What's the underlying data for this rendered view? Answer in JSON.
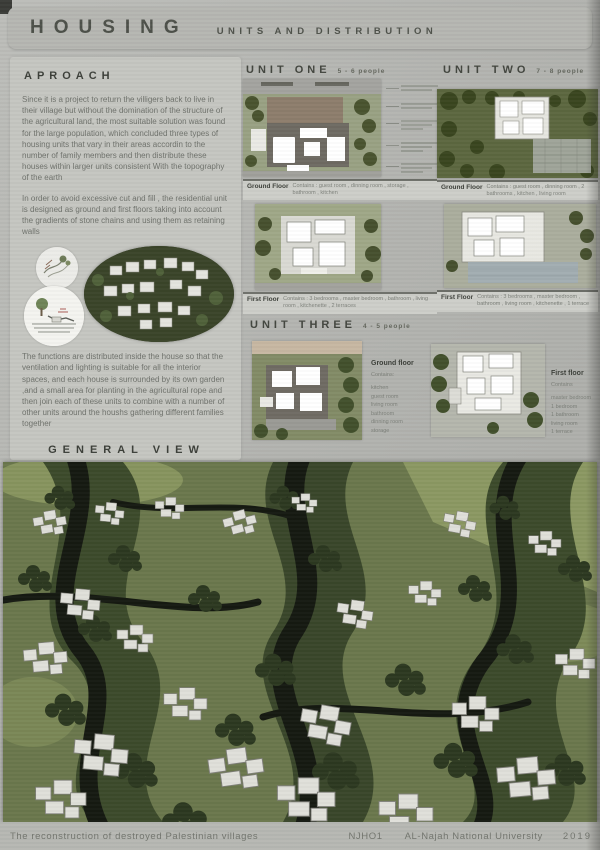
{
  "header": {
    "title": "HOUSING",
    "subtitle": "UNITS AND DISTRIBUTION"
  },
  "approach": {
    "heading": "APROACH",
    "para1": "Since it is a project to return the villigers back  to live in their village but without the  domination of the structure of the agricultural land, the most suitable solution was found for the  large population, which concluded three types of housing units that vary in their areas accordin  to the number of family members and then distribute these houses within larger units consistent With the topography of the earth",
    "para2": "In order to avoid excessive cut and fill , the residential unit is designed as ground and first floors taking into account the gradients of stone chains and  using them as retaining walls",
    "para3": "The functions are distributed inside the house so that the ventilation and lighting is suitable for all the interior spaces, and each house is surrounded by its own garden ,and a small area for planting in the agricultural rope and then join each of these units to combine with a number of other units around the houshs  gathering different families together",
    "general_view_label": "GENERAL VIEW"
  },
  "units": {
    "one": {
      "title": "UNIT ONE",
      "capacity": "5 - 6  people",
      "ground_label": "Ground Floor",
      "ground_contains": "Contains : guest room , dinning room , storage , bathroom , kitchen",
      "first_label": "First Floor",
      "first_contains": "Contains : 3 bedrooms , master bedroom , bathroom , living room , kitchenette , 2 terraces"
    },
    "two": {
      "title": "UNIT TWO",
      "capacity": "7 - 8  people",
      "ground_label": "Ground Floor",
      "ground_contains": "Contains : guest room , dinning room , 2 bathrooms , kitchen , living room",
      "first_label": "First Floor",
      "first_contains": "Contains : 3 bedrooms , master bedroom , bathroom , living room , kitchenette , 1 terrace"
    },
    "three": {
      "title": "UNIT THREE",
      "capacity": "4 - 5  people",
      "ground_label": "Ground floor",
      "ground_contains_label": "Contains:",
      "ground_items": [
        "kitchen",
        "guest room",
        "living room",
        "bathroom",
        "dinning room",
        "storage"
      ],
      "first_label": "First floor",
      "first_contains_label": "Contains",
      "first_items": [
        "master bedroom",
        "1 bedroom",
        "1 bathroom",
        "living room",
        "1 terrace"
      ]
    }
  },
  "footer": {
    "caption": "The reconstruction  of  destroyed  Palestinian  villages",
    "code": "NJHO1",
    "university": "AL-Najah  National  University",
    "year": "2019"
  }
}
